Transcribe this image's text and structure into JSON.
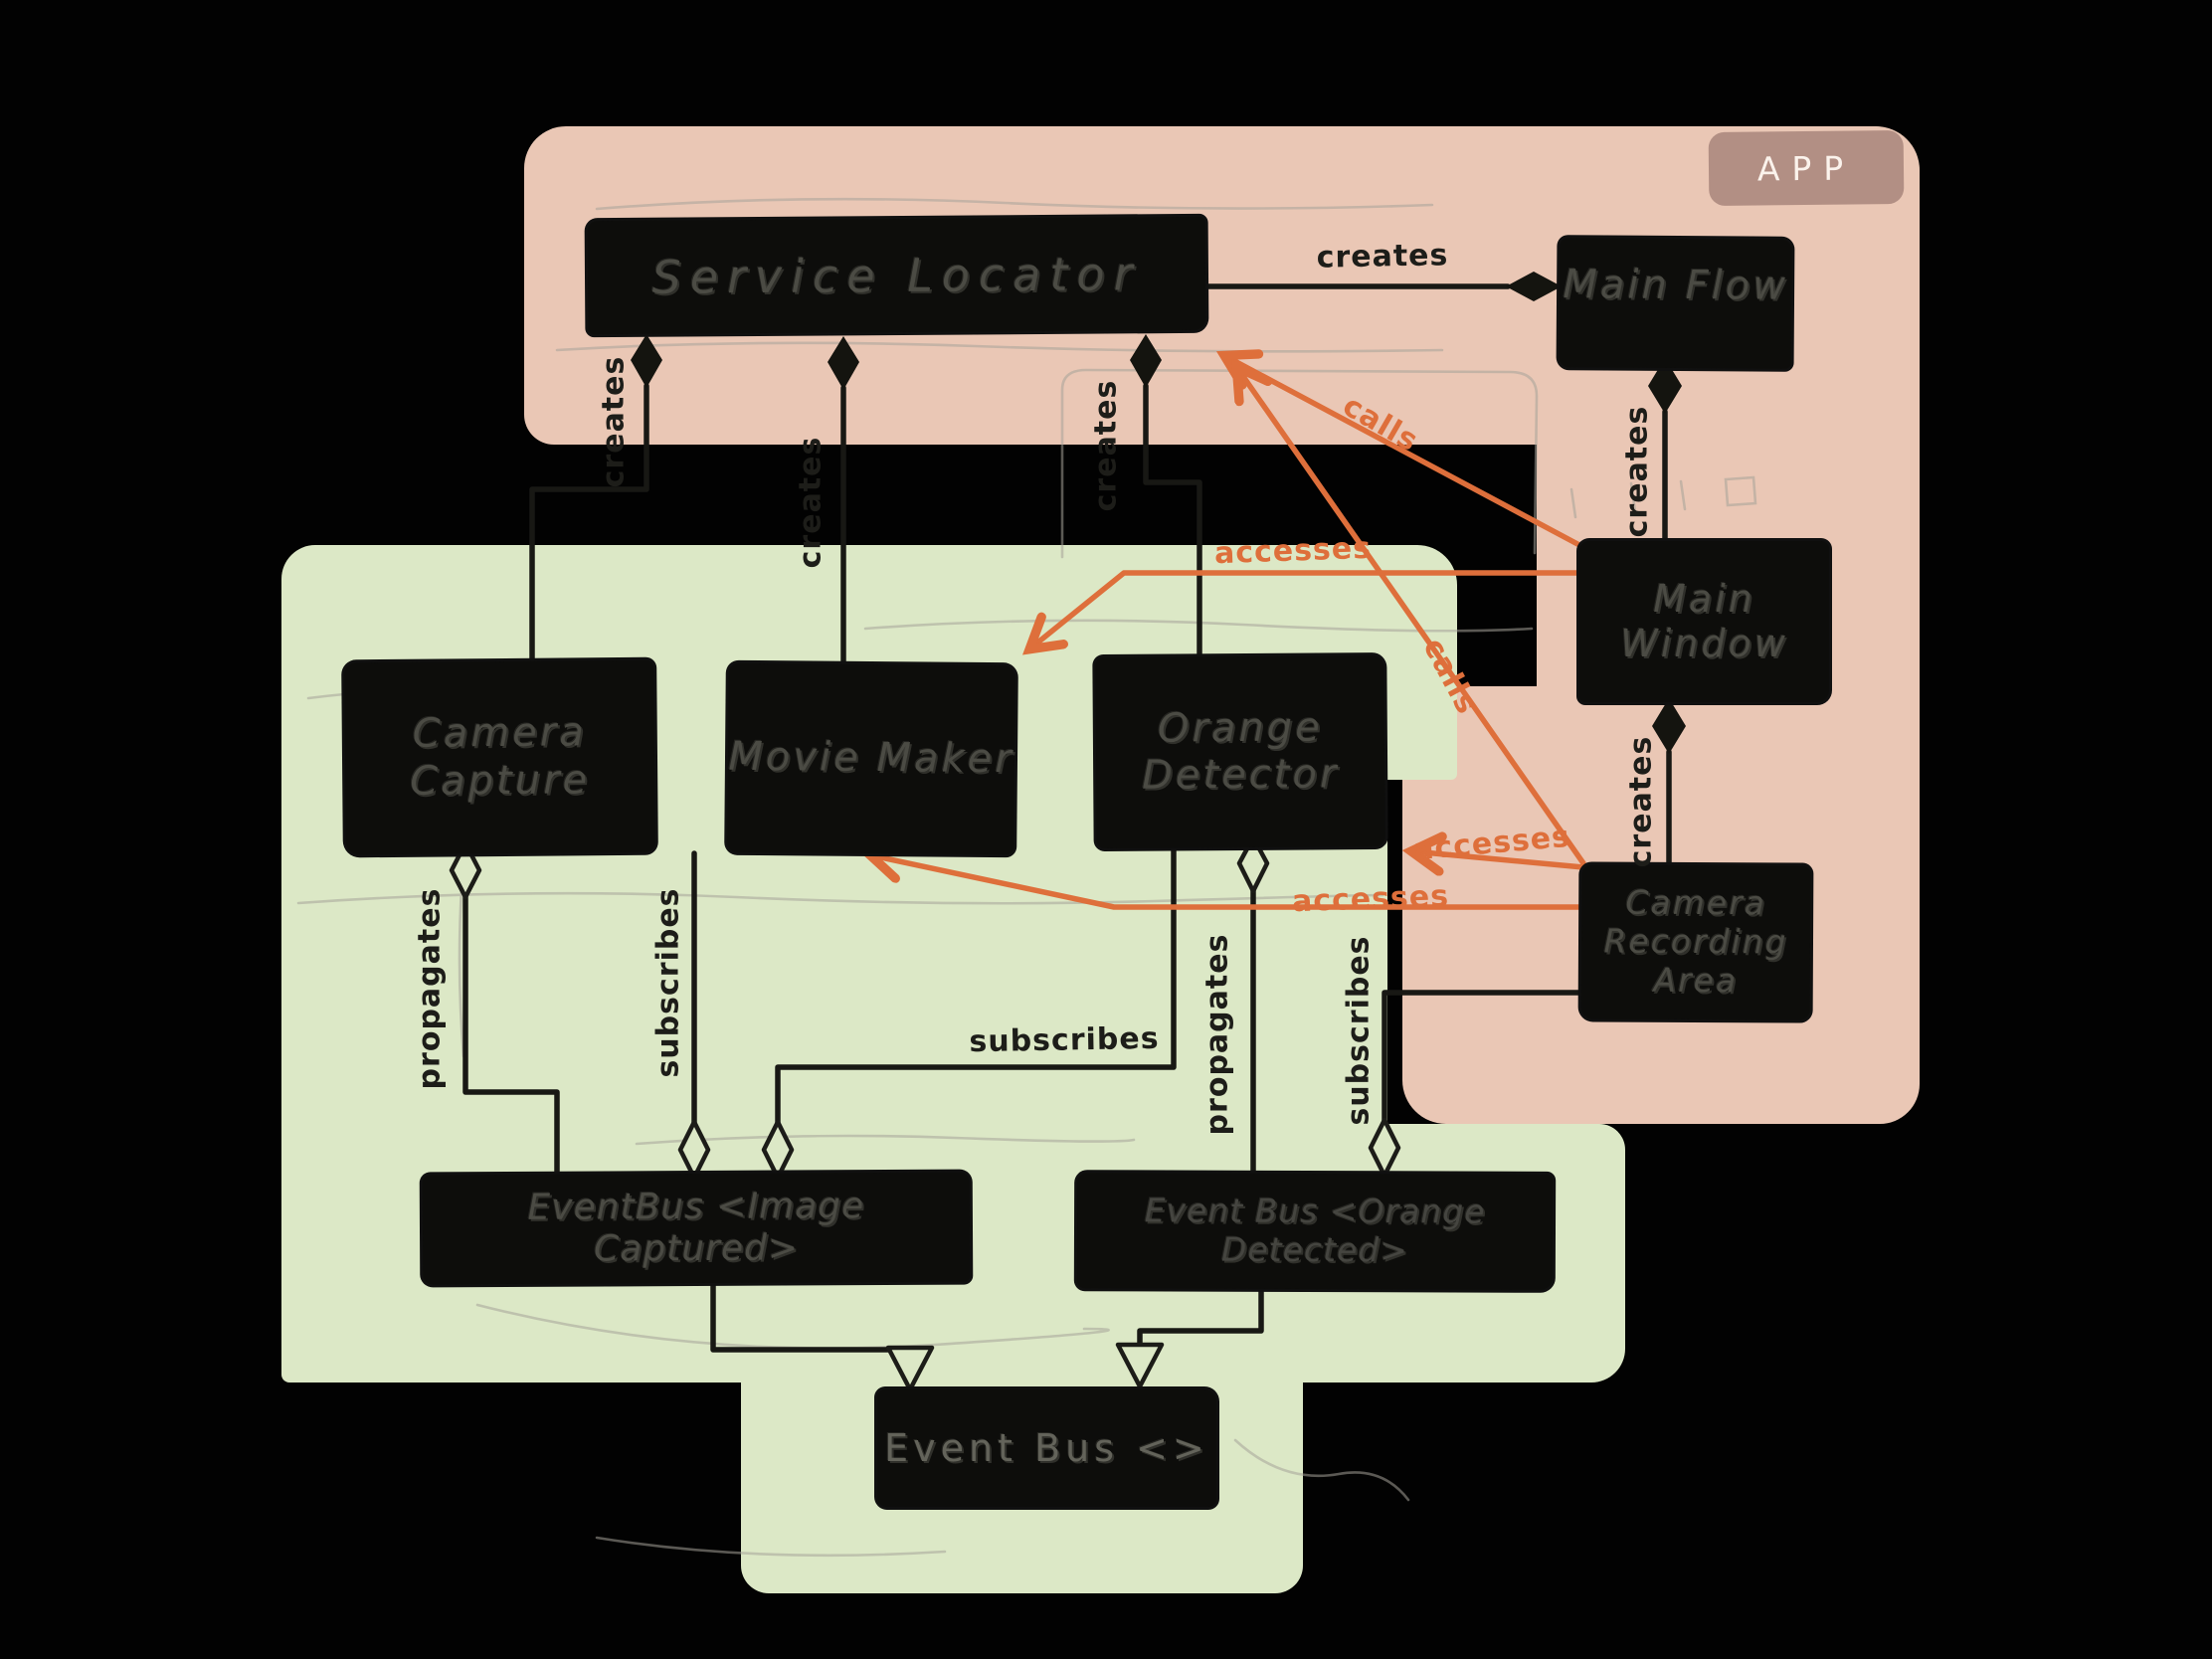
{
  "canvas": {
    "app_group_label": "APP"
  },
  "nodes": {
    "service_locator": {
      "label": "Service Locator"
    },
    "main_flow": {
      "label": "Main Flow"
    },
    "main_window": {
      "label": "Main Window"
    },
    "camera_capture": {
      "label": "Camera Capture"
    },
    "movie_maker": {
      "label": "Movie Maker"
    },
    "orange_detector": {
      "label": "Orange Detector"
    },
    "camera_recording_area": {
      "label": "Camera Recording Area"
    },
    "event_bus_image_captured": {
      "label": "EventBus <Image Captured>"
    },
    "event_bus_orange_detected": {
      "label": "Event Bus <Orange Detected>"
    },
    "event_bus_generic": {
      "label": "Event Bus <>"
    }
  },
  "edge_labels": {
    "sl_to_main_flow": "creates",
    "main_window_to_main_flow": "creates",
    "cra_to_main_window": "creates",
    "sl_to_camera_capture": "creates",
    "sl_to_movie_maker": "creates",
    "sl_to_orange_detector": "creates",
    "camera_capture_to_image_bus": "propagates",
    "movie_maker_to_image_bus": "subscribes",
    "orange_detector_to_image_bus": "subscribes",
    "orange_detector_to_orange_bus": "propagates",
    "cra_to_orange_bus": "subscribes",
    "main_window_calls_sl": "calls",
    "cra_calls_sl": "calls",
    "main_window_accesses_movie_maker": "accesses",
    "cra_accesses_orange_detector": "accesses",
    "cra_accesses_movie_maker": "accesses"
  },
  "colors": {
    "background": "#020202",
    "app_region": "#eac7b5",
    "domain_region": "#dce8c6",
    "node_fill": "#0d0d0b",
    "node_text": "#4b4b44",
    "edge_black": "#181814",
    "accent_orange": "#de6f3b",
    "chip_fill": "#a68379",
    "pencil": "#a6a399"
  }
}
